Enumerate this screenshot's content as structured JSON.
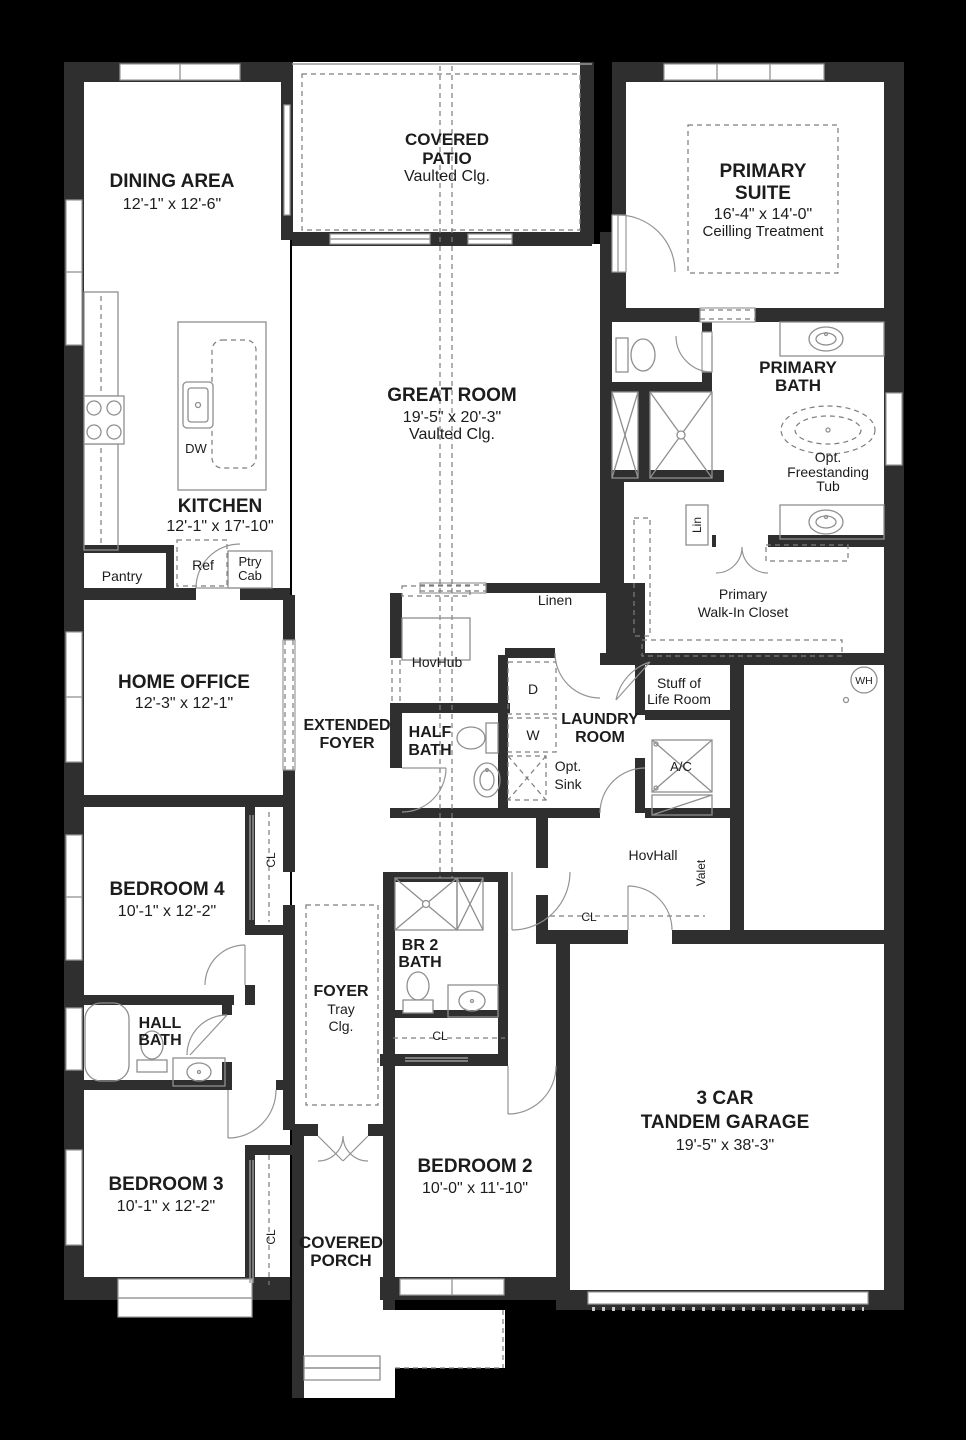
{
  "plan": {
    "colors": {
      "background": "#000000",
      "wall": "#2f2f2f",
      "room": "#ffffff",
      "accent_line": "#8f8f8f"
    },
    "rooms": {
      "dining": {
        "name": "DINING AREA",
        "dims": "12'-1\" x 12'-6\""
      },
      "covered_patio": {
        "line1": "COVERED",
        "line2": "PATIO",
        "note": "Vaulted Clg."
      },
      "primary_suite": {
        "line1": "PRIMARY",
        "line2": "SUITE",
        "dims": "16'-4\" x 14'-0\"",
        "note": "Ceilling Treatment"
      },
      "great_room": {
        "name": "GREAT ROOM",
        "dims": "19'-5\" x 20'-3\"",
        "note": "Vaulted Clg."
      },
      "primary_bath": {
        "line1": "PRIMARY",
        "line2": "BATH"
      },
      "opt_tub": {
        "line1": "Opt.",
        "line2": "Freestanding",
        "line3": "Tub"
      },
      "lin_closet": {
        "label": "Lin"
      },
      "walk_in_closet": {
        "line1": "Primary",
        "line2": "Walk-In Closet"
      },
      "kitchen": {
        "name": "KITCHEN",
        "dims": "12'-1\" x 17'-10\""
      },
      "pantry": {
        "label": "Pantry"
      },
      "dishwasher": {
        "label": "DW"
      },
      "refrigerator": {
        "label": "Ref"
      },
      "pantry_cabinet": {
        "line1": "Ptry",
        "line2": "Cab"
      },
      "home_office": {
        "name": "HOME OFFICE",
        "dims": "12'-3\" x 12'-1\""
      },
      "extended_foyer": {
        "line1": "EXTENDED",
        "line2": "FOYER"
      },
      "hovhub": {
        "label": "HovHub"
      },
      "linen": {
        "label": "Linen"
      },
      "half_bath": {
        "line1": "HALF",
        "line2": "BATH"
      },
      "laundry": {
        "line1": "LAUNDRY",
        "line2": "ROOM"
      },
      "dryer": {
        "label": "D"
      },
      "washer": {
        "label": "W"
      },
      "opt_sink": {
        "line1": "Opt.",
        "line2": "Sink"
      },
      "stuff_of_life": {
        "line1": "Stuff of",
        "line2": "Life Room"
      },
      "ac": {
        "label": "A/C"
      },
      "water_heater": {
        "label": "WH"
      },
      "hovhall": {
        "label": "HovHall"
      },
      "valet": {
        "label": "Valet"
      },
      "bedroom4": {
        "name": "BEDROOM 4",
        "dims": "10'-1\" x 12'-2\""
      },
      "cl_bed4": {
        "label": "CL"
      },
      "cl_hall": {
        "label": "CL"
      },
      "foyer": {
        "line1": "FOYER",
        "line2": "Tray",
        "line3": "Clg."
      },
      "br2_bath": {
        "line1": "BR 2",
        "line2": "BATH"
      },
      "cl_br2": {
        "label": "CL"
      },
      "hall_bath": {
        "line1": "HALL",
        "line2": "BATH"
      },
      "bedroom3": {
        "name": "BEDROOM 3",
        "dims": "10'-1\" x 12'-2\""
      },
      "cl_bed3": {
        "label": "CL"
      },
      "covered_porch": {
        "line1": "COVERED",
        "line2": "PORCH"
      },
      "bedroom2": {
        "name": "BEDROOM 2",
        "dims": "10'-0\" x 11'-10\""
      },
      "garage": {
        "line1": "3 CAR",
        "line2": "TANDEM GARAGE",
        "dims": "19'-5\" x 38'-3\""
      }
    }
  }
}
